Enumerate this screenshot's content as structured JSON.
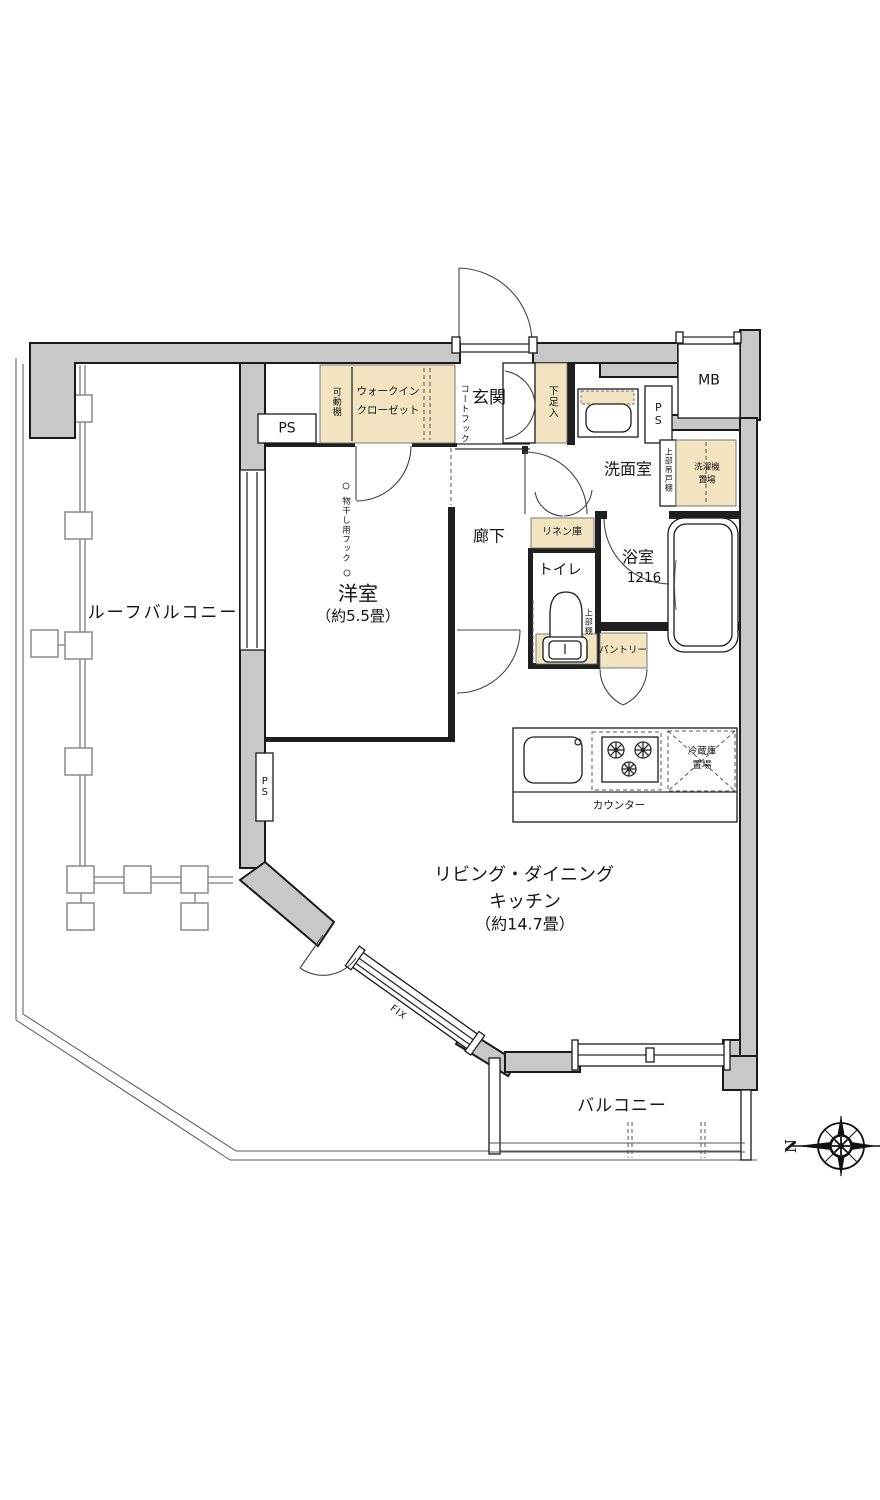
{
  "plan": {
    "rooms": {
      "roof_balcony": "ルーフバルコニー",
      "western_room": "洋室",
      "western_room_size": "（約5.5畳）",
      "ldk_line1": "リビング・ダイニング",
      "ldk_line2": "キッチン",
      "ldk_size": "（約14.7畳）",
      "balcony": "バルコニー",
      "entrance": "玄関",
      "hallway": "廊下",
      "washroom": "洗面室",
      "bathroom": "浴室",
      "bathroom_size": "1216",
      "toilet": "トイレ"
    },
    "storage": {
      "wic_line1": "ウォークイン",
      "wic_line2": "クローゼット",
      "movable_shelf": "可動棚",
      "coat_hook": "コートフック",
      "shoe_cabinet": "下足入",
      "linen_cabinet": "リネン庫",
      "pantry": "パントリー",
      "upper_shelf": "上部棚",
      "upper_hanging_cabinet": "上部吊戸棚",
      "washer_space_line1": "洗濯機",
      "washer_space_line2": "置場",
      "fridge_space_line1": "冷蔵庫",
      "fridge_space_line2": "置場",
      "counter": "カウンター",
      "laundry_hook": "物干し用フック"
    },
    "service": {
      "mb": "MB",
      "ps": "PS"
    },
    "annotations": {
      "fix_window": "FIX",
      "compass_north": "N"
    },
    "colors": {
      "wall_fill": "#c8c8c8",
      "storage_fill": "#f2e4c0",
      "outline": "#1a1a1a"
    }
  }
}
